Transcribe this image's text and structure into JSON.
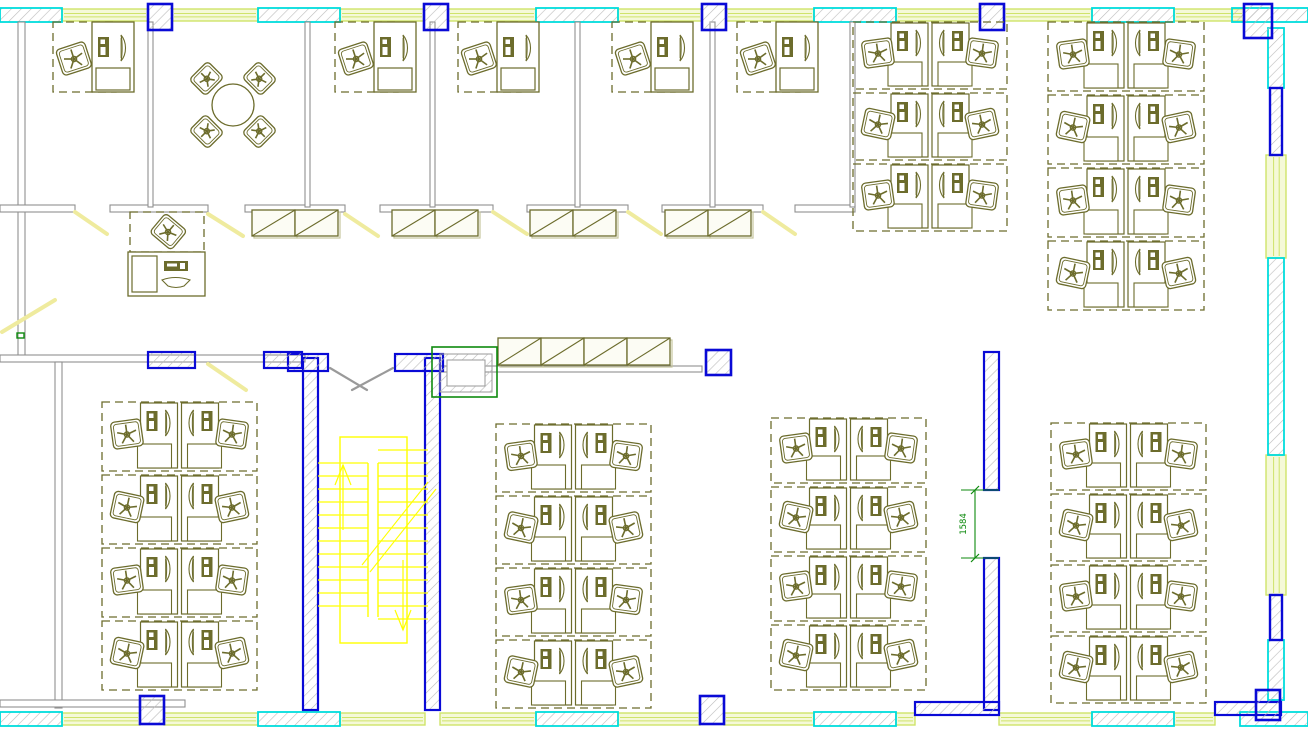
{
  "floorplan": {
    "canvas": {
      "w": 1308,
      "h": 736
    },
    "colors": {
      "olive": "#6c6c2c",
      "oliveLight": "#c6c69e",
      "gray": "#8f8f8f",
      "hatch": "#bcbcbc",
      "blue": "#0a0ad6",
      "cyan": "#00dcdc",
      "lime": "#cfe36a",
      "limeFill": "#f5f9d8",
      "yellow": "#ffff00",
      "paleYellow": "#efeb9e",
      "green": "#0e8a0e",
      "white": "#ffffff"
    },
    "walls": {
      "cyanPiers": [
        {
          "x": 0,
          "y": 8,
          "w": 62,
          "h": 14
        },
        {
          "x": 258,
          "y": 8,
          "w": 82,
          "h": 14
        },
        {
          "x": 536,
          "y": 8,
          "w": 82,
          "h": 14
        },
        {
          "x": 814,
          "y": 8,
          "w": 82,
          "h": 14
        },
        {
          "x": 1092,
          "y": 8,
          "w": 82,
          "h": 14
        },
        {
          "x": 1232,
          "y": 8,
          "w": 76,
          "h": 14
        },
        {
          "x": 0,
          "y": 712,
          "w": 62,
          "h": 14
        },
        {
          "x": 258,
          "y": 712,
          "w": 82,
          "h": 14
        },
        {
          "x": 536,
          "y": 712,
          "w": 82,
          "h": 14
        },
        {
          "x": 814,
          "y": 712,
          "w": 82,
          "h": 14
        },
        {
          "x": 1092,
          "y": 712,
          "w": 82,
          "h": 14
        },
        {
          "x": 1240,
          "y": 712,
          "w": 68,
          "h": 14
        },
        {
          "x": 1268,
          "y": 28,
          "w": 16,
          "h": 60
        },
        {
          "x": 1268,
          "y": 258,
          "w": 16,
          "h": 197
        },
        {
          "x": 1268,
          "y": 640,
          "w": 16,
          "h": 60
        }
      ],
      "limeWindows": [
        {
          "x": 62,
          "y": 9,
          "w": 86,
          "h": 12
        },
        {
          "x": 172,
          "y": 9,
          "w": 86,
          "h": 12
        },
        {
          "x": 340,
          "y": 9,
          "w": 84,
          "h": 12
        },
        {
          "x": 448,
          "y": 9,
          "w": 88,
          "h": 12
        },
        {
          "x": 618,
          "y": 9,
          "w": 84,
          "h": 12
        },
        {
          "x": 726,
          "y": 9,
          "w": 88,
          "h": 12
        },
        {
          "x": 896,
          "y": 9,
          "w": 84,
          "h": 12
        },
        {
          "x": 1004,
          "y": 9,
          "w": 88,
          "h": 12
        },
        {
          "x": 1174,
          "y": 9,
          "w": 70,
          "h": 12
        },
        {
          "x": 62,
          "y": 713,
          "w": 78,
          "h": 12
        },
        {
          "x": 164,
          "y": 713,
          "w": 94,
          "h": 12
        },
        {
          "x": 340,
          "y": 713,
          "w": 85,
          "h": 12
        },
        {
          "x": 440,
          "y": 713,
          "w": 96,
          "h": 12
        },
        {
          "x": 618,
          "y": 713,
          "w": 82,
          "h": 12
        },
        {
          "x": 724,
          "y": 713,
          "w": 90,
          "h": 12
        },
        {
          "x": 896,
          "y": 713,
          "w": 19,
          "h": 12
        },
        {
          "x": 999,
          "y": 713,
          "w": 93,
          "h": 12
        },
        {
          "x": 1174,
          "y": 713,
          "w": 41,
          "h": 12
        },
        {
          "x": 1266,
          "y": 155,
          "w": 20,
          "h": 103
        },
        {
          "x": 1266,
          "y": 455,
          "w": 20,
          "h": 140
        }
      ],
      "blueColumns": [
        {
          "x": 148,
          "y": 4,
          "w": 24,
          "h": 26
        },
        {
          "x": 424,
          "y": 4,
          "w": 24,
          "h": 26
        },
        {
          "x": 702,
          "y": 4,
          "w": 24,
          "h": 26
        },
        {
          "x": 980,
          "y": 4,
          "w": 24,
          "h": 26
        },
        {
          "x": 1244,
          "y": 4,
          "w": 28,
          "h": 34
        },
        {
          "x": 140,
          "y": 696,
          "w": 24,
          "h": 28
        },
        {
          "x": 700,
          "y": 696,
          "w": 24,
          "h": 28
        },
        {
          "x": 1256,
          "y": 690,
          "w": 24,
          "h": 30
        },
        {
          "x": 706,
          "y": 350,
          "w": 25,
          "h": 25
        }
      ],
      "bluePiers": [
        {
          "x": 1270,
          "y": 88,
          "w": 12,
          "h": 67
        },
        {
          "x": 1270,
          "y": 595,
          "w": 12,
          "h": 45
        }
      ],
      "blueWalls": [
        {
          "x": 303,
          "y": 358,
          "w": 15,
          "h": 352
        },
        {
          "x": 425,
          "y": 358,
          "w": 15,
          "h": 352
        },
        {
          "x": 288,
          "y": 354,
          "w": 40,
          "h": 17
        },
        {
          "x": 395,
          "y": 354,
          "w": 48,
          "h": 17
        },
        {
          "x": 984,
          "y": 352,
          "w": 15,
          "h": 138
        },
        {
          "x": 984,
          "y": 558,
          "w": 15,
          "h": 152
        },
        {
          "x": 915,
          "y": 702,
          "w": 84,
          "h": 13
        },
        {
          "x": 1215,
          "y": 702,
          "w": 66,
          "h": 13
        },
        {
          "x": 148,
          "y": 352,
          "w": 47,
          "h": 16
        },
        {
          "x": 264,
          "y": 352,
          "w": 38,
          "h": 16
        }
      ],
      "grayWalls": [
        {
          "x": 18,
          "y": 22,
          "w": 7,
          "h": 336
        },
        {
          "x": 0,
          "y": 205,
          "w": 75,
          "h": 7
        },
        {
          "x": 110,
          "y": 205,
          "w": 98,
          "h": 7
        },
        {
          "x": 245,
          "y": 205,
          "w": 100,
          "h": 7
        },
        {
          "x": 380,
          "y": 205,
          "w": 113,
          "h": 7
        },
        {
          "x": 527,
          "y": 205,
          "w": 101,
          "h": 7
        },
        {
          "x": 662,
          "y": 205,
          "w": 101,
          "h": 7
        },
        {
          "x": 795,
          "y": 205,
          "w": 60,
          "h": 7
        },
        {
          "x": 148,
          "y": 22,
          "w": 5,
          "h": 185
        },
        {
          "x": 305,
          "y": 22,
          "w": 5,
          "h": 185
        },
        {
          "x": 430,
          "y": 22,
          "w": 5,
          "h": 185
        },
        {
          "x": 575,
          "y": 22,
          "w": 5,
          "h": 185
        },
        {
          "x": 710,
          "y": 22,
          "w": 5,
          "h": 185
        },
        {
          "x": 850,
          "y": 22,
          "w": 5,
          "h": 185
        },
        {
          "x": 0,
          "y": 355,
          "w": 305,
          "h": 7
        },
        {
          "x": 440,
          "y": 366,
          "w": 262,
          "h": 6
        },
        {
          "x": 55,
          "y": 362,
          "w": 7,
          "h": 346
        },
        {
          "x": 0,
          "y": 700,
          "w": 185,
          "h": 7
        }
      ]
    },
    "furniture": {
      "offices": [
        {
          "x": 53,
          "y": 22
        },
        {
          "x": 335,
          "y": 22
        },
        {
          "x": 458,
          "y": 22
        },
        {
          "x": 612,
          "y": 22
        },
        {
          "x": 737,
          "y": 22
        }
      ],
      "clusters": [
        {
          "x": 852,
          "y": 20,
          "w": 156,
          "rows": 3,
          "rowH": 71
        },
        {
          "x": 1047,
          "y": 20,
          "w": 158,
          "rows": 4,
          "rowH": 73
        },
        {
          "x": 101,
          "y": 400,
          "w": 157,
          "rows": 4,
          "rowH": 73
        },
        {
          "x": 495,
          "y": 422,
          "w": 157,
          "rows": 4,
          "rowH": 72
        },
        {
          "x": 770,
          "y": 416,
          "w": 157,
          "rows": 4,
          "rowH": 69
        },
        {
          "x": 1050,
          "y": 421,
          "w": 157,
          "rows": 4,
          "rowH": 71
        }
      ],
      "cabinets": [
        {
          "x": 252,
          "y": 210,
          "cells": 2,
          "cw": 43,
          "h": 26
        },
        {
          "x": 392,
          "y": 210,
          "cells": 2,
          "cw": 43,
          "h": 26
        },
        {
          "x": 530,
          "y": 210,
          "cells": 2,
          "cw": 43,
          "h": 26
        },
        {
          "x": 665,
          "y": 210,
          "cells": 2,
          "cw": 43,
          "h": 26
        },
        {
          "x": 498,
          "y": 338,
          "cells": 4,
          "cw": 43,
          "h": 27
        }
      ],
      "meetingTable": {
        "cx": 233,
        "cy": 105,
        "r": 21,
        "chairDist": 37
      },
      "reception": {
        "x": 130,
        "y": 212
      }
    },
    "stair": {
      "left": 318,
      "right": 428,
      "divL": 368,
      "divR": 378,
      "top": 437,
      "bottom": 643,
      "landH": 26,
      "boxX": 340,
      "boxW": 67,
      "stepH": 13
    },
    "shaft": {
      "x": 432,
      "y": 347,
      "w": 65,
      "h": 50
    },
    "doors": [
      {
        "x1": 75,
        "y1": 212,
        "x2": 107,
        "y2": 234
      },
      {
        "x1": 208,
        "y1": 214,
        "x2": 243,
        "y2": 236
      },
      {
        "x1": 345,
        "y1": 214,
        "x2": 378,
        "y2": 236
      },
      {
        "x1": 493,
        "y1": 212,
        "x2": 527,
        "y2": 234
      },
      {
        "x1": 628,
        "y1": 212,
        "x2": 661,
        "y2": 234
      },
      {
        "x1": 763,
        "y1": 212,
        "x2": 795,
        "y2": 234
      },
      {
        "x1": 208,
        "y1": 364,
        "x2": 246,
        "y2": 390
      },
      {
        "x1": 2,
        "y1": 332,
        "x2": 55,
        "y2": 300
      }
    ],
    "doorLeaves": [
      {
        "x1": 330,
        "y1": 368,
        "x2": 367,
        "y2": 390
      },
      {
        "x1": 393,
        "y1": 368,
        "x2": 352,
        "y2": 390
      }
    ],
    "dimension": {
      "text": "1584",
      "lineX": 975,
      "y1": 490,
      "y2": 558,
      "tickX1": 961,
      "tickX2": 999,
      "textX": 966,
      "textY": 524
    },
    "greenTick": {
      "x": 17,
      "y": 333,
      "w": 7,
      "h": 5
    }
  }
}
